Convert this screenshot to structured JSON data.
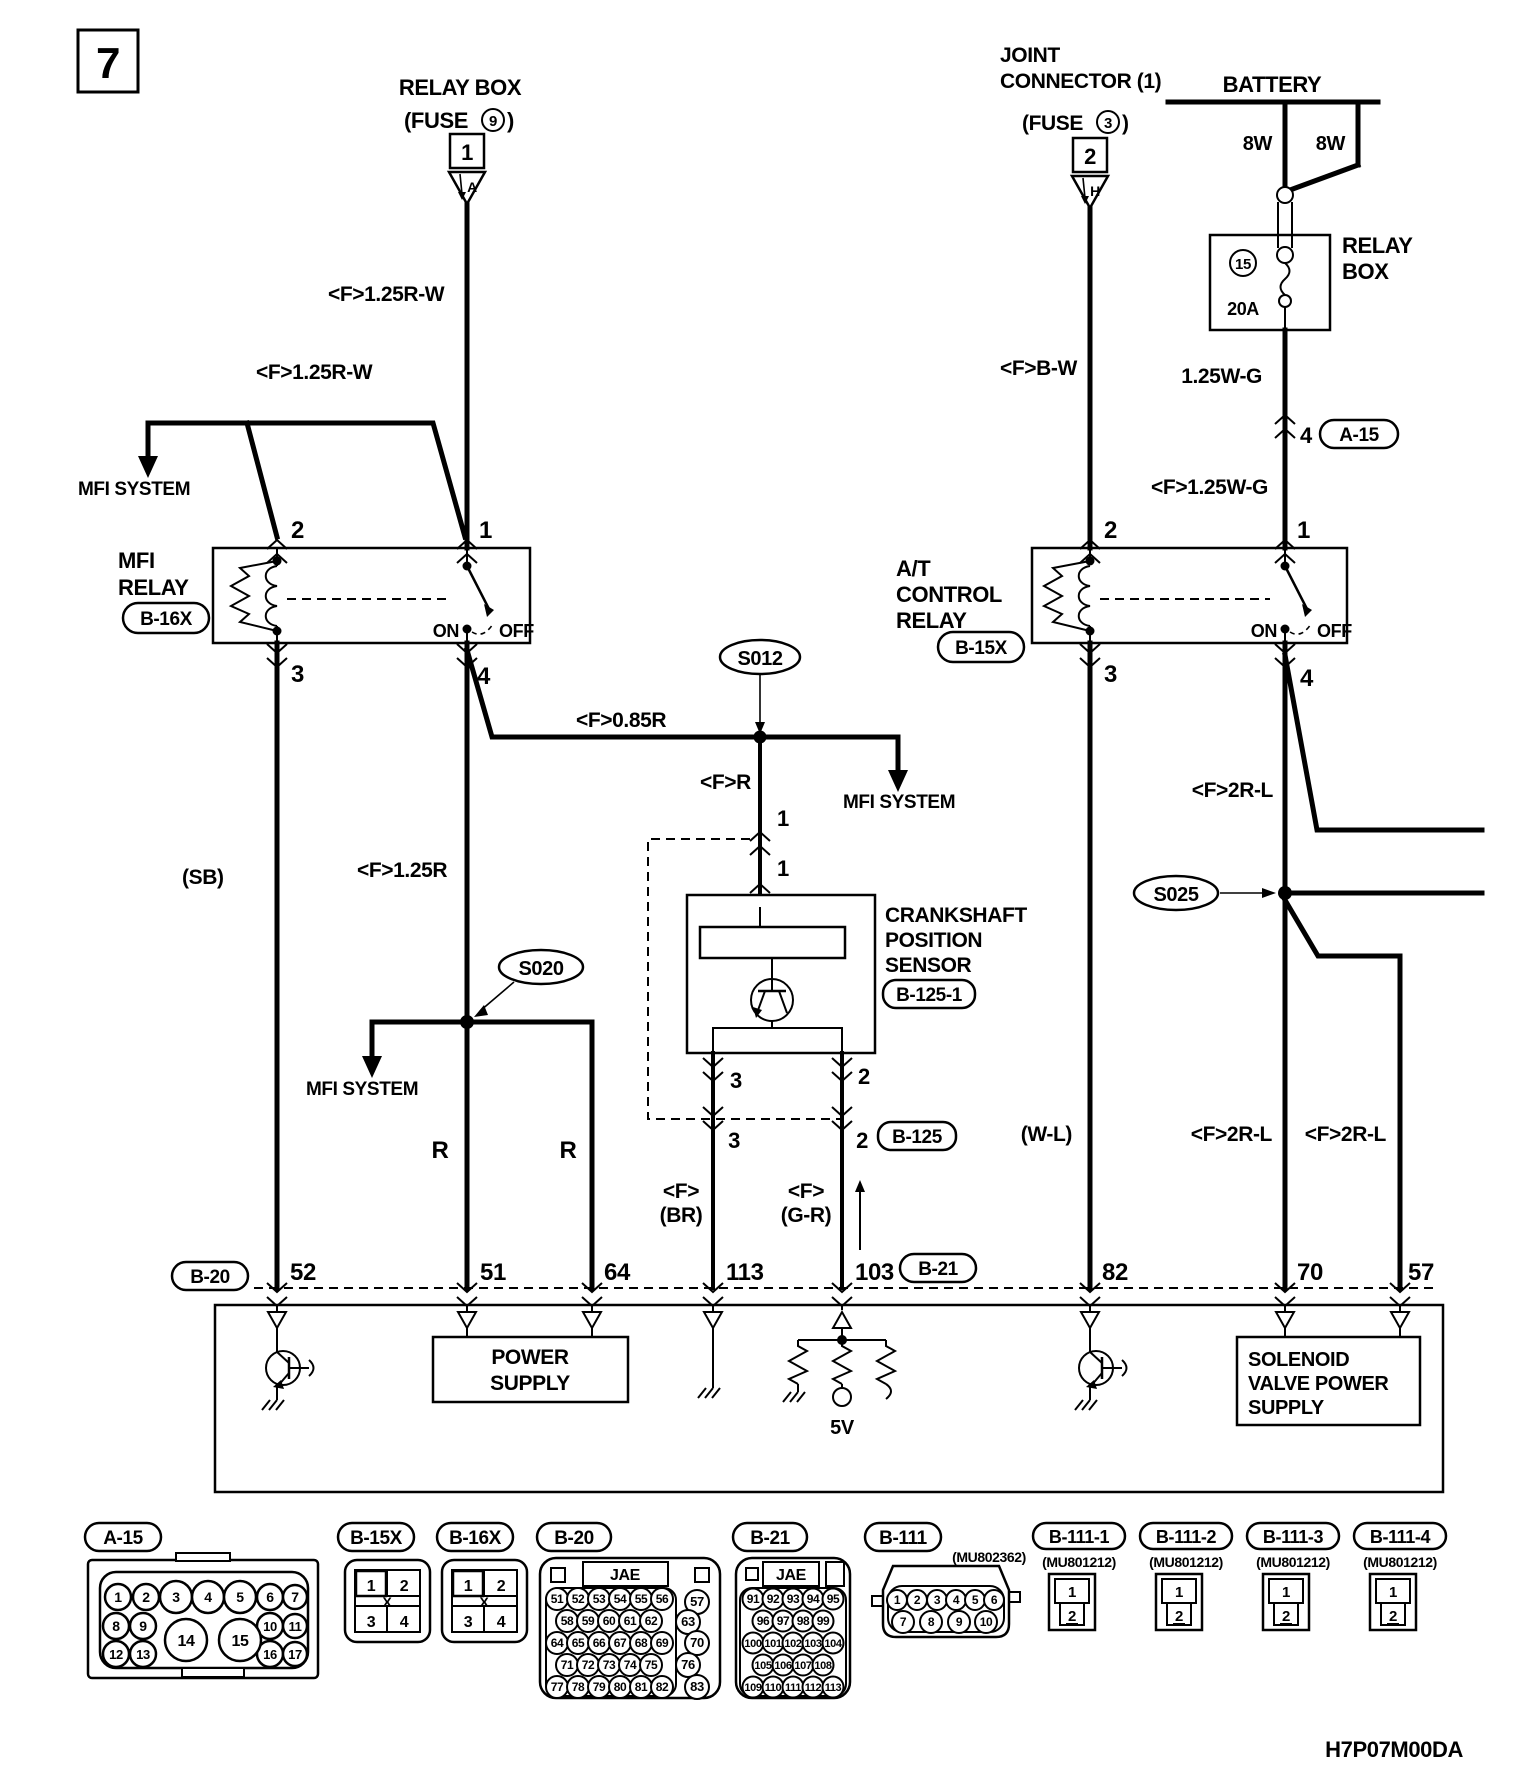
{
  "figure": {
    "number": "7",
    "doc_code": "H7P07M00DA"
  },
  "top_left_fuse": {
    "title": "RELAY BOX",
    "fuse_open": "(FUSE",
    "fuse_num": "9",
    "fuse_close": ")",
    "box_num": "1",
    "tri_letter": "A"
  },
  "joint_connector": {
    "l1": "JOINT",
    "l2": "CONNECTOR (1)",
    "fuse_open": "(FUSE",
    "fuse_num": "3",
    "fuse_close": ")",
    "box_num": "2",
    "tri_letter": "H"
  },
  "battery": {
    "title": "BATTERY",
    "w1": "8W",
    "w2": "8W"
  },
  "relay_box_fuse": {
    "l1": "RELAY",
    "l2": "BOX",
    "num": "15",
    "rating": "20A"
  },
  "inline_conn": {
    "pin": "4",
    "code": "A-15"
  },
  "wires": {
    "rw1": "<F>1.25R-W",
    "rw2": "<F>1.25R-W",
    "bw": "<F>B-W",
    "wg1": "1.25W-G",
    "wg2": "<F>1.25W-G",
    "r085": "<F>0.85R",
    "r": "<F>R",
    "r125": "<F>1.25R",
    "sb": "(SB)",
    "r_a": "R",
    "r_b": "R",
    "br1": "<F>",
    "br2": "(BR)",
    "gr1": "<F>",
    "gr2": "(G-R)",
    "wl": "(W-L)",
    "rl1": "<F>2R-L",
    "rl2": "<F>2R-L",
    "rl3": "<F>2R-L"
  },
  "mfi_system": {
    "a": "MFI SYSTEM",
    "b": "MFI SYSTEM",
    "c": "MFI SYSTEM"
  },
  "mfi_relay": {
    "n1": "MFI",
    "n2": "RELAY",
    "code": "B-16X",
    "p1": "1",
    "p2": "2",
    "p3": "3",
    "p4": "4",
    "on": "ON",
    "off": "OFF"
  },
  "at_relay": {
    "n1": "A/T",
    "n2": "CONTROL",
    "n3": "RELAY",
    "code": "B-15X",
    "p1": "1",
    "p2": "2",
    "p3": "3",
    "p4": "4",
    "on": "ON",
    "off": "OFF"
  },
  "splices": {
    "s012": "S012",
    "s020": "S020",
    "s025": "S025"
  },
  "sensor": {
    "l1": "CRANKSHAFT",
    "l2": "POSITION",
    "l3": "SENSOR",
    "code": "B-125-1",
    "top_pin_a": "1",
    "top_pin_b": "1",
    "pin3": "3",
    "pin2": "2",
    "conn3": "3",
    "conn2": "2",
    "conn_code": "B-125"
  },
  "ecu": {
    "left_code": "B-20",
    "right_code": "B-21",
    "p52": "52",
    "p51": "51",
    "p64": "64",
    "p113": "113",
    "p103": "103",
    "p82": "82",
    "p70": "70",
    "p57": "57",
    "ps1": "POWER",
    "ps2": "SUPPLY",
    "sv1": "SOLENOID",
    "sv2": "VALVE POWER",
    "sv3": "SUPPLY",
    "v5": "5V"
  },
  "conn_view": {
    "a15": {
      "label": "A-15",
      "r1": [
        "1",
        "2",
        "3",
        "4",
        "5",
        "6",
        "7"
      ],
      "r2l": [
        "8",
        "9"
      ],
      "r2r": [
        "10",
        "11"
      ],
      "r3l": [
        "12",
        "13"
      ],
      "r3r": [
        "16",
        "17"
      ],
      "big": [
        "14",
        "15"
      ]
    },
    "b15x": {
      "label": "B-15X",
      "c": [
        "1",
        "2",
        "3",
        "4"
      ],
      "x": "X"
    },
    "b16x": {
      "label": "B-16X",
      "c": [
        "1",
        "2",
        "3",
        "4"
      ],
      "x": "X"
    },
    "b20": {
      "label": "B-20",
      "maker": "JAE",
      "r1": [
        "51",
        "52",
        "53",
        "54",
        "55",
        "56"
      ],
      "r2": [
        "58",
        "59",
        "60",
        "61",
        "62"
      ],
      "r3": [
        "64",
        "65",
        "66",
        "67",
        "68",
        "69"
      ],
      "r4": [
        "71",
        "72",
        "73",
        "74",
        "75"
      ],
      "r5": [
        "77",
        "78",
        "79",
        "80",
        "81",
        "82"
      ],
      "rc": [
        "57",
        "63",
        "70",
        "76",
        "83"
      ]
    },
    "b21": {
      "label": "B-21",
      "maker": "JAE",
      "r1": [
        "91",
        "92",
        "93",
        "94",
        "95"
      ],
      "r2": [
        "96",
        "97",
        "98",
        "99"
      ],
      "r3": [
        "100",
        "101",
        "102",
        "103",
        "104"
      ],
      "r4": [
        "105",
        "106",
        "107",
        "108"
      ],
      "r5": [
        "109",
        "110",
        "111",
        "112",
        "113"
      ]
    },
    "b111": {
      "label": "B-111",
      "part": "(MU802362)",
      "r1": [
        "1",
        "2",
        "3",
        "4",
        "5",
        "6"
      ],
      "r2": [
        "7",
        "8",
        "9",
        "10"
      ]
    },
    "subs": [
      {
        "label": "B-111-1",
        "part": "(MU801212)",
        "p1": "1",
        "p2": "2"
      },
      {
        "label": "B-111-2",
        "part": "(MU801212)",
        "p1": "1",
        "p2": "2"
      },
      {
        "label": "B-111-3",
        "part": "(MU801212)",
        "p1": "1",
        "p2": "2"
      },
      {
        "label": "B-111-4",
        "part": "(MU801212)",
        "p1": "1",
        "p2": "2"
      }
    ]
  }
}
